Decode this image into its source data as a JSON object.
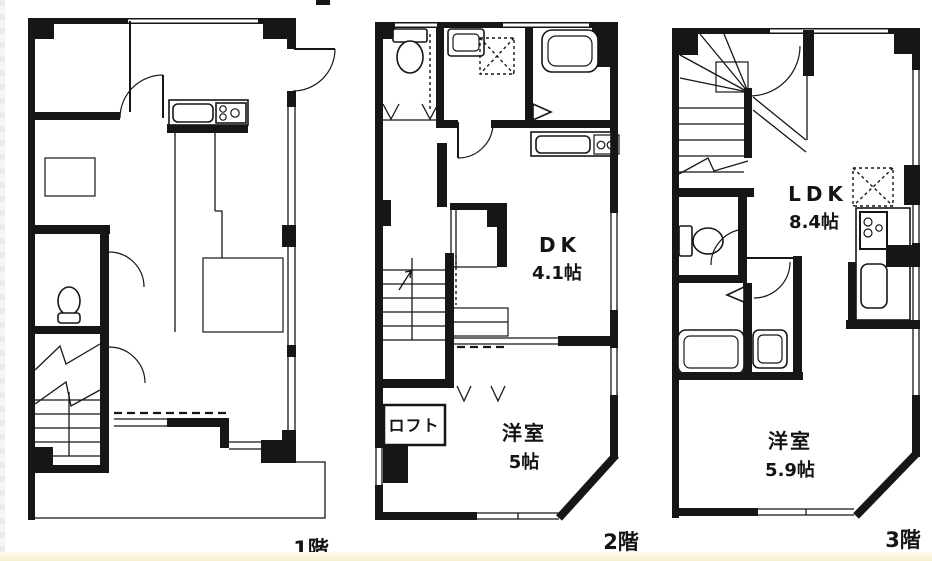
{
  "colors": {
    "line": "#161616",
    "background": "#ffffff",
    "footer_strip": "#f5efcf"
  },
  "floors": [
    {
      "label": "1階"
    },
    {
      "label": "2階",
      "rooms": {
        "dk": {
          "name": "DK",
          "size": "4.1帖"
        },
        "loft": {
          "name": "ロフト"
        },
        "bedroom": {
          "name": "洋室",
          "size": "5帖"
        }
      }
    },
    {
      "label": "3階",
      "rooms": {
        "ldk": {
          "name": "LDK",
          "size": "8.4帖"
        },
        "bedroom": {
          "name": "洋室",
          "size": "5.9帖"
        }
      }
    }
  ]
}
